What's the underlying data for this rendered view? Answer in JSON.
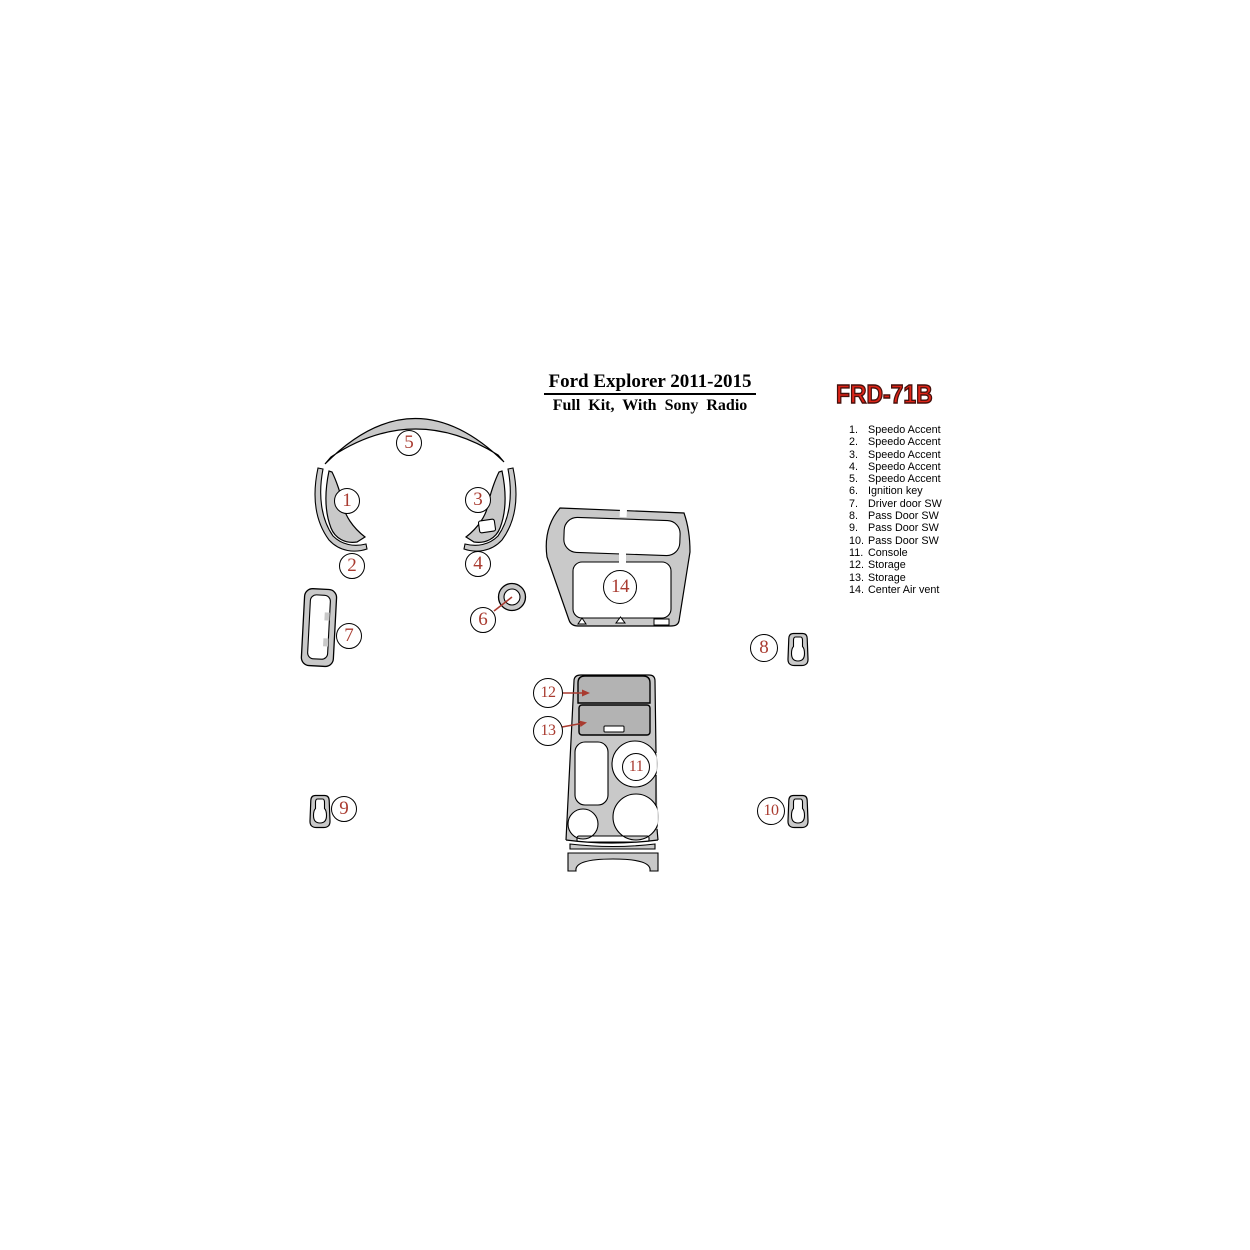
{
  "title": {
    "line1": "Ford Explorer 2011-2015",
    "line2": "Full Kit, With Sony Radio"
  },
  "part_code": "FRD-71B",
  "parts": [
    {
      "num": "1.",
      "label": "Speedo Accent"
    },
    {
      "num": "2.",
      "label": "Speedo Accent"
    },
    {
      "num": "3.",
      "label": "Speedo Accent"
    },
    {
      "num": "4.",
      "label": "Speedo Accent"
    },
    {
      "num": "5.",
      "label": "Speedo Accent"
    },
    {
      "num": "6.",
      "label": "Ignition key"
    },
    {
      "num": "7.",
      "label": "Driver door SW"
    },
    {
      "num": "8.",
      "label": "Pass Door SW"
    },
    {
      "num": "9.",
      "label": "Pass Door SW"
    },
    {
      "num": "10.",
      "label": "Pass Door SW"
    },
    {
      "num": "11.",
      "label": "Console"
    },
    {
      "num": "12.",
      "label": "Storage"
    },
    {
      "num": "13.",
      "label": "Storage"
    },
    {
      "num": "14.",
      "label": "Center Air vent"
    }
  ],
  "callout_numbers": [
    "1",
    "2",
    "3",
    "4",
    "5",
    "6",
    "7",
    "8",
    "9",
    "10",
    "11",
    "12",
    "13",
    "14"
  ],
  "colors": {
    "piece_gray": "#c9c9c9",
    "panel_gray": "#b3b3b3",
    "outline_black": "#000000",
    "callout_red": "#a93b30",
    "code_red": "#df2418",
    "code_outline": "#45100b"
  }
}
